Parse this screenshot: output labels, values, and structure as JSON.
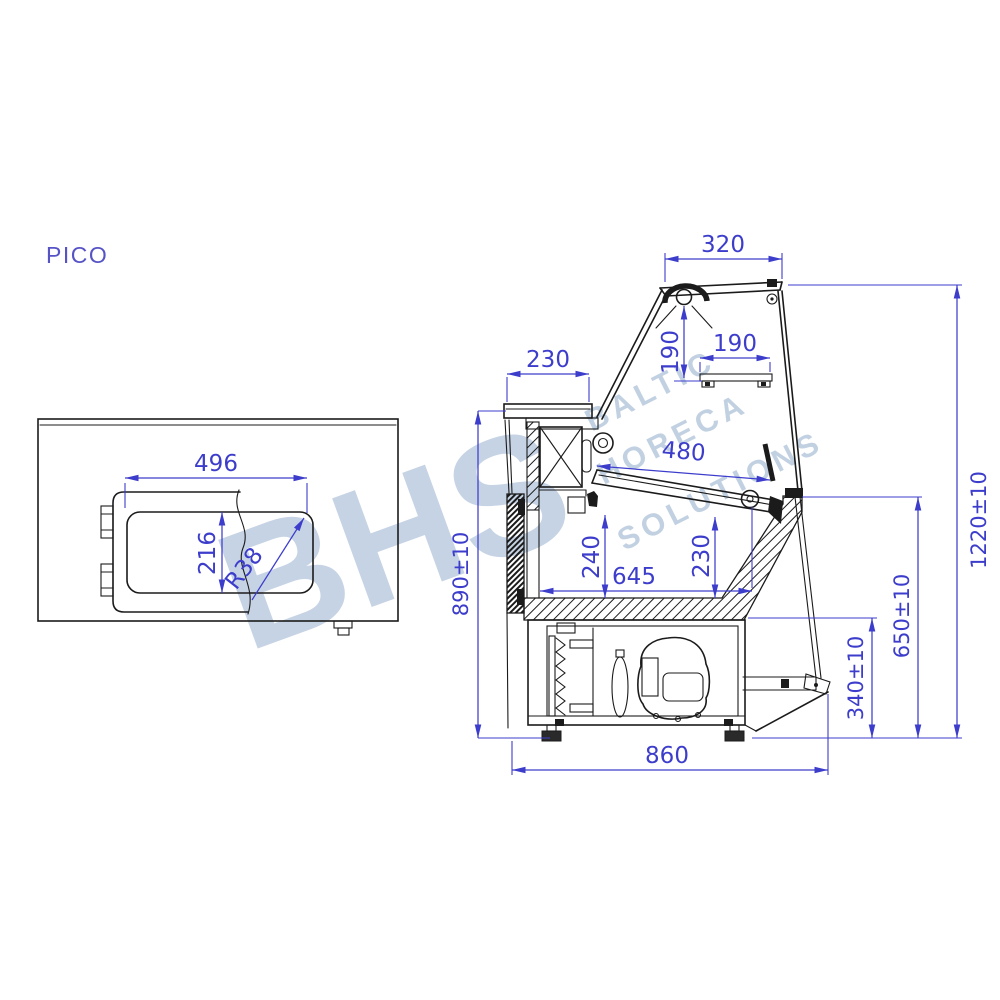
{
  "title": "PICO",
  "watermark": {
    "logo": "BHS",
    "words": [
      "BALTIC",
      "HORECA",
      "SOLUTIONS"
    ]
  },
  "colors": {
    "drawing_line": "#1b1b1b",
    "dimension": "#3d3dcc",
    "title": "#5653c6",
    "watermark": "#b8c9de",
    "background": "#ffffff"
  },
  "top_view": {
    "dims": {
      "opening_width": "496",
      "opening_depth": "216",
      "corner_radius": "R38"
    }
  },
  "side_view": {
    "dims": {
      "canopy_width": "320",
      "lamp_drop": "190",
      "shelf_width": "190",
      "counter_depth": "230",
      "deck_length": "480",
      "deck_height": "240",
      "well_height": "230",
      "well_width": "645",
      "front_height": "890±10",
      "machine_height": "340±10",
      "rear_glass_height": "650±10",
      "total_height": "1220±10",
      "base_depth": "860"
    }
  }
}
